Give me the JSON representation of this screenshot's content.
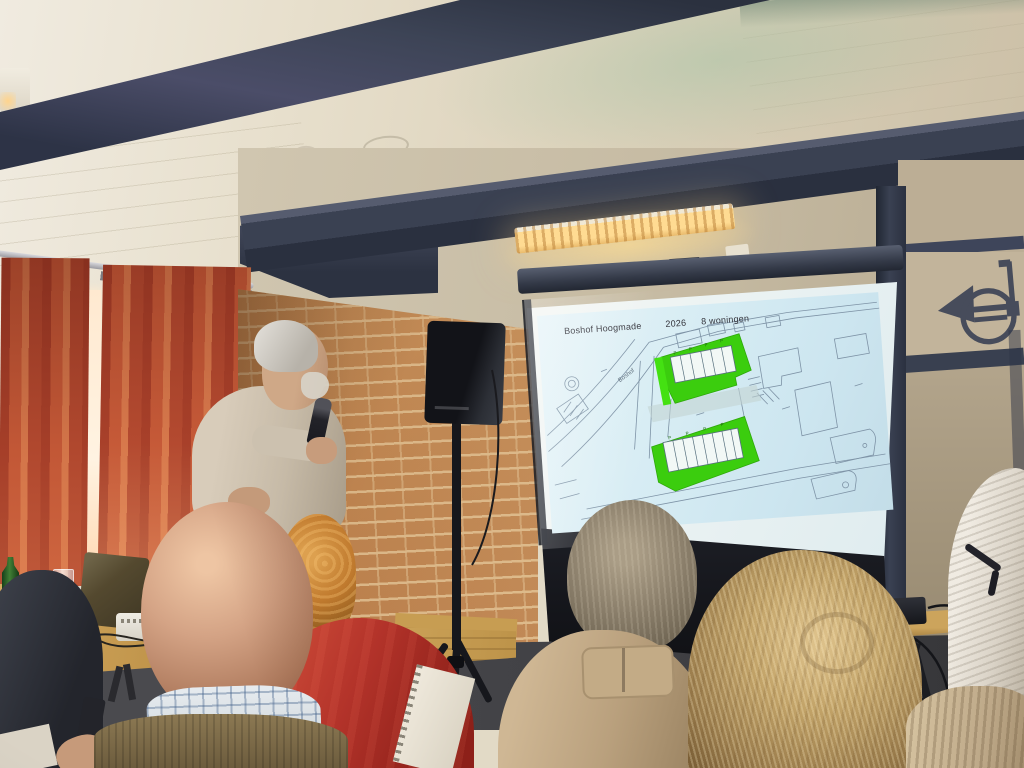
{
  "scene": {
    "description": "Speaker presenting a housing development site plan to a seated audience in a community hall",
    "slide": {
      "project": "Boshof Hoogmade",
      "year": "2026",
      "units": "8 woningen",
      "street_label": "Boshof",
      "parking_mark": "P"
    },
    "colors": {
      "slide-bg": "#d8edf4",
      "slide-line": "#7e93a6",
      "plan-green": "#3bcd0e",
      "beam": "#3a4152",
      "ceiling": "#e2dac6",
      "curtain": "#b44a30",
      "brick": "#b87c49",
      "right-wall": "#b2a48b",
      "floor": "#414145",
      "screen-casing": "#343a48",
      "red-sweater": "#b3332a"
    },
    "icons": {
      "horn_emblem": "french-horn-logo"
    }
  }
}
